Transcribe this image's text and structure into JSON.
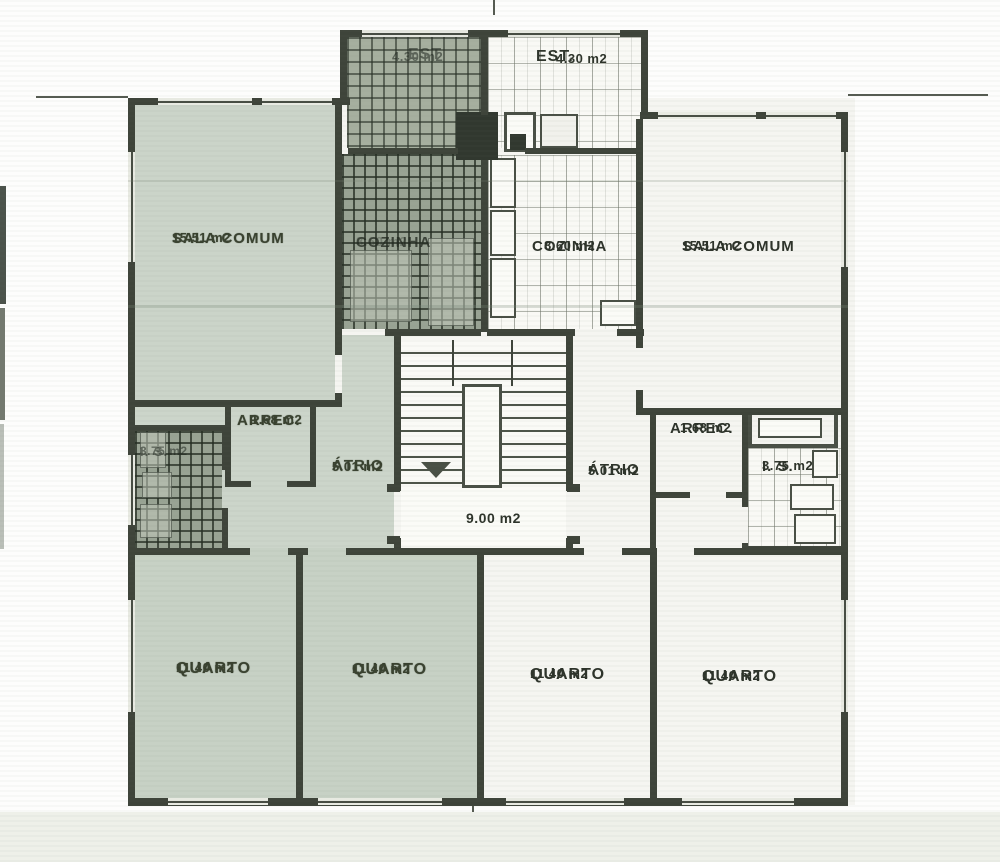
{
  "document": {
    "kind": "apartment floor plan (scanned)",
    "language": "Portuguese"
  },
  "colors": {
    "wall_ink": "#3e443a",
    "left_unit_tint": "#cbd4c9",
    "right_unit_fill": "#f5f5f1",
    "paper": "#fdfdfc"
  },
  "stairwell": {
    "area": "9.00 m2"
  },
  "left_unit": {
    "rooms": [
      {
        "name": "est",
        "label": "EST",
        "area": "4.30 m2"
      },
      {
        "name": "sala-comum",
        "label": "SALA COMUM",
        "area": "15.51 m2"
      },
      {
        "name": "cozinha",
        "label": "COZINHA",
        "area": "8.60 m2"
      },
      {
        "name": "arrecadacao",
        "label": "ARREC.",
        "area": "1.68 m2"
      },
      {
        "name": "atrio",
        "label": "ÁTRIO",
        "area": "5.01 m2"
      },
      {
        "name": "instalacao-sanitaria",
        "label": "I. S.",
        "area": "3.75 m2"
      },
      {
        "name": "quarto-1",
        "label": "QUARTO",
        "area": "11.40 m2"
      },
      {
        "name": "quarto-2",
        "label": "QUARTO",
        "area": "11.40 m2"
      }
    ]
  },
  "right_unit": {
    "rooms": [
      {
        "name": "est",
        "label": "EST.",
        "area": "4.30 m2"
      },
      {
        "name": "sala-comum",
        "label": "SALA COMUM",
        "area": "15.51 m2"
      },
      {
        "name": "cozinha",
        "label": "COZINHA",
        "area": "8.60 m2"
      },
      {
        "name": "arrecadacao",
        "label": "ARREC.",
        "area": "1.68 m2"
      },
      {
        "name": "atrio",
        "label": "ÁTRIO",
        "area": "5.01 m2"
      },
      {
        "name": "instalacao-sanitaria",
        "label": "I. S.",
        "area": "3.75 m2"
      },
      {
        "name": "quarto-3",
        "label": "QUARTO",
        "area": "11.40 m2"
      },
      {
        "name": "quarto-4",
        "label": "QUARTO",
        "area": "11.40 m2"
      }
    ]
  }
}
